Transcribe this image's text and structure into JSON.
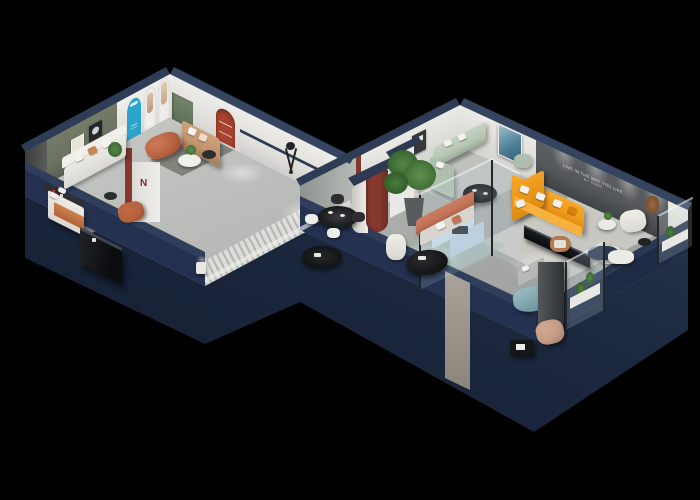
{
  "scene": {
    "title": "3D isometric cutaway floor plan of a furniture showroom on a black background",
    "background": "#000000",
    "wall_slogan_line1": "LIVE IN THE WAY YOU LIKE",
    "wall_slogan_line2": "MY HOME",
    "partition_logo": "N"
  },
  "palette": {
    "navy_top": "#32405c",
    "navy_face": "#243150",
    "navy_deep": "#101a2c",
    "floor_light": "#c9cac8",
    "floor_mid": "#a8aaa7",
    "wall_white": "#e9e8e4",
    "olive_wall": "#6b7261",
    "accent_wall": "#54575a",
    "cyan_arch": "#2aa4ca",
    "maroon": "#84382e",
    "red_arch": "#a8432f",
    "orange_sofa": "#f09a1c",
    "terracotta": "#b5613f",
    "tan_sofa": "#c2946f",
    "rust_sofa": "#c27257",
    "sage_sofa": "#b7c6b5",
    "teal_ottoman": "#7fa3ad",
    "pale_blue": "#c5d8e5",
    "plant_green": "#4a7b3f",
    "black_furniture": "#17181a",
    "white_furniture": "#eceae5",
    "marble": "#d6d0c5"
  },
  "rooms": [
    {
      "name": "gallery-lounge",
      "items": [
        "white sofa",
        "tan sofa",
        "terracotta ottoman",
        "olive accent wall with two framed artworks",
        "cyan arch panel",
        "white poster arches",
        "green door",
        "round side table",
        "potted plant",
        "striped dark rug"
      ]
    },
    {
      "name": "bedroom-display",
      "items": [
        "bed with orange throw",
        "black glossy sideboard",
        "terracotta armchair",
        "desk chair",
        "white nightstand"
      ]
    },
    {
      "name": "dining-area",
      "items": [
        "black round dining table",
        "four shell chairs",
        "black oval coffee table",
        "tripod floor lamp",
        "red arched niche column"
      ]
    },
    {
      "name": "main-lounge",
      "items": [
        "orange L-shaped sectional sofa",
        "black media console",
        "white armchairs",
        "round side tables",
        "teddy-bear figure",
        "dark slogan accent wall with downlights"
      ]
    },
    {
      "name": "sage-lounge",
      "items": [
        "sage sectional sofa",
        "black round coffee table",
        "blue abstract painting",
        "dark wall frames"
      ]
    },
    {
      "name": "glass-bedroom-showcase",
      "items": [
        "glass partitions",
        "pale blue bed and cabinets"
      ]
    },
    {
      "name": "rust-lounge",
      "items": [
        "rust-trimmed sofa",
        "black organic coffee table",
        "white armchair",
        "large potted tree",
        "teal rug"
      ]
    },
    {
      "name": "south-display",
      "items": [
        "teal ottoman bed",
        "gray bed",
        "dark wardrobe column",
        "tan lounge chair",
        "black magazine stand",
        "glass plant cases",
        "entry door with marble strip"
      ]
    }
  ]
}
